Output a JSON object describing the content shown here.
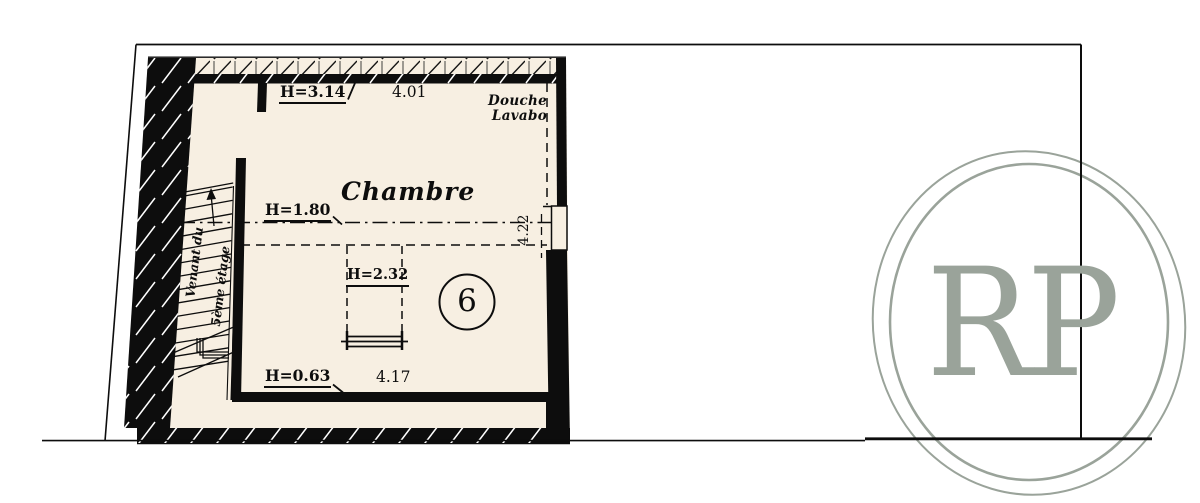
{
  "plan": {
    "room_label": "Chambre",
    "shower_label": "Douche",
    "sink_label": "Lavabo",
    "room_number": "6",
    "stairs_label_1": "Venant du",
    "stairs_label_2": "5ème étage",
    "dims": {
      "top_height": "H=3.14",
      "top_width": "4.01",
      "mid_height": "H=1.80",
      "right_depth": "4.22",
      "skylight_height": "H=2.32",
      "bottom_height": "H=0.63",
      "bottom_width": "4.17"
    }
  },
  "logo": {
    "monogram": "RP"
  },
  "colors": {
    "floor": "#f7efe2",
    "ink": "#0d0d0d",
    "logo": "#9aa39a"
  }
}
